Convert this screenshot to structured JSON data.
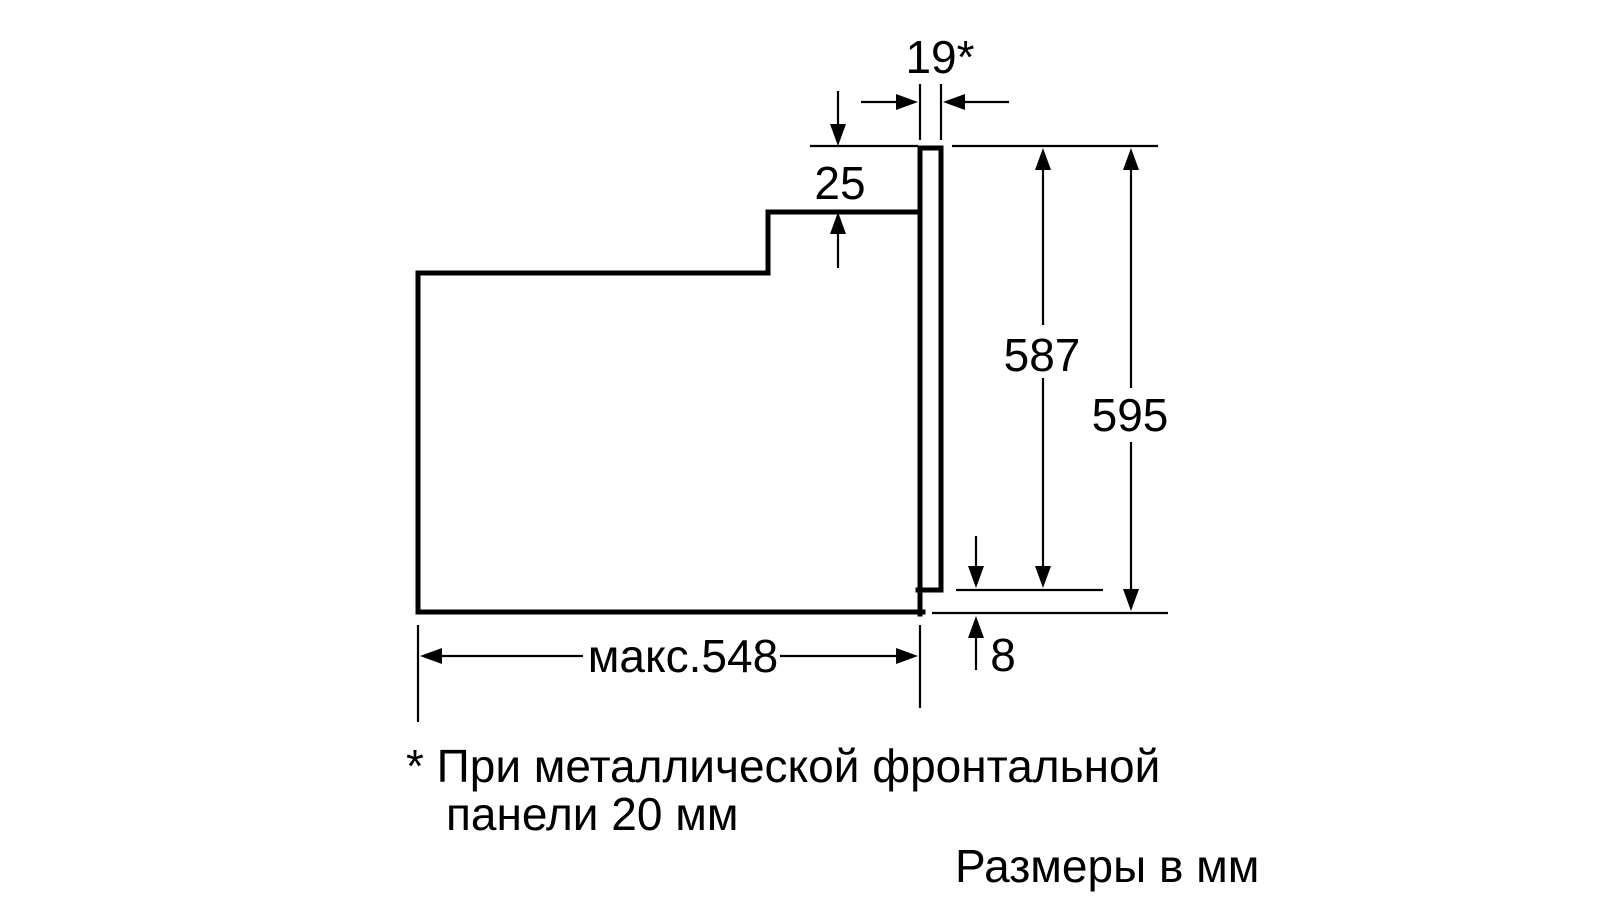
{
  "diagram": {
    "type": "appliance-installation-drawing",
    "units_caption": "Размеры в мм",
    "footnote": {
      "line1": "* При металлической фронтальной",
      "line2": "панели 20 мм"
    },
    "dimensions": {
      "front_panel_thickness": "19*",
      "top_recess": "25",
      "height_to_door_bottom": "587",
      "total_front_height": "595",
      "max_depth": "макс.548",
      "bottom_clearance": "8"
    },
    "colors": {
      "line": "#000000",
      "background": "#ffffff"
    }
  }
}
